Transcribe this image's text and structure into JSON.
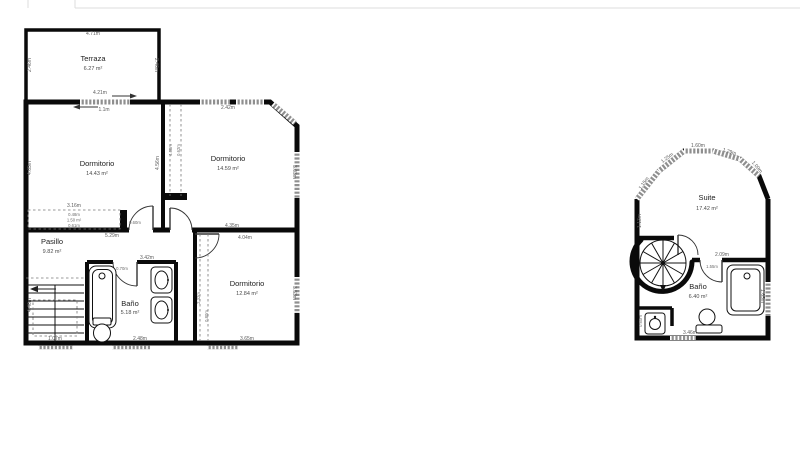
{
  "page": {
    "background": "#ffffff",
    "wall_color": "#0a0a0a",
    "window_color": "#8f8f8f",
    "text_color": "#3c3c3c"
  },
  "left_plan": {
    "rooms": {
      "terraza": {
        "name": "Terraza",
        "area": "6.27 m²"
      },
      "dormitorio_1": {
        "name": "Dormitorio",
        "area": "14.43 m²"
      },
      "dormitorio_2": {
        "name": "Dormitorio",
        "area": "14.59 m²"
      },
      "dormitorio_3": {
        "name": "Dormitorio",
        "area": "12.84 m²"
      },
      "pasillo": {
        "name": "Pasillo",
        "area": "9.82 m²"
      },
      "bano": {
        "name": "Baño",
        "area": "5.18 m²"
      }
    },
    "dims": {
      "terraza_top": "4.71m",
      "terraza_left": "2.46m",
      "terraza_right": "2.46m",
      "terraza_door_width": "4.21m",
      "terraza_door_leaf": "1.1m",
      "dorm1_left": "4.65m",
      "dorm1_right": "4.56m",
      "wardrobe_width": "3.16m",
      "wardrobe_depth": "0.48m",
      "wardrobe_area": "1.50 m²",
      "wardrobe_front": "0.61m",
      "dorm2_top": "2.42m",
      "dorm2_side_a": "4.68m",
      "dorm2_side_b": "0.62m",
      "dorm2_right": "3.03m",
      "dorm2_bottom": "4.35m",
      "pasillo_length": "5.29m",
      "door_1": "0.60m",
      "dorm3_top": "4.04m",
      "dorm3_right": "3.53m",
      "dorm3_bottom": "3.65m",
      "dorm3_left_a": "2.32m",
      "dorm3_left_b": "0.80m",
      "bano_top": "3.42m",
      "bano_door": "0.70m",
      "bano_bottom": "2.48m",
      "stairs_bottom": "1.07m",
      "stairs_left": "4.46m"
    }
  },
  "right_plan": {
    "rooms": {
      "suite": {
        "name": "Suite",
        "area": "17.42 m²"
      },
      "bano": {
        "name": "Baño",
        "area": "6.40 m²"
      }
    },
    "dims": {
      "bay_top": "1.60m",
      "bay_upper_left": "1.25m",
      "bay_left": "1.15m",
      "bay_upper_right": "1.29m",
      "bay_right": "1.09m",
      "wall_left": "1.13m",
      "suite_bano_wall": "2.09m",
      "bano_door": "1.55m",
      "bath_side": "1.65m",
      "bano_bottom": "3.46m",
      "sink_alcove": "0.60m"
    }
  }
}
